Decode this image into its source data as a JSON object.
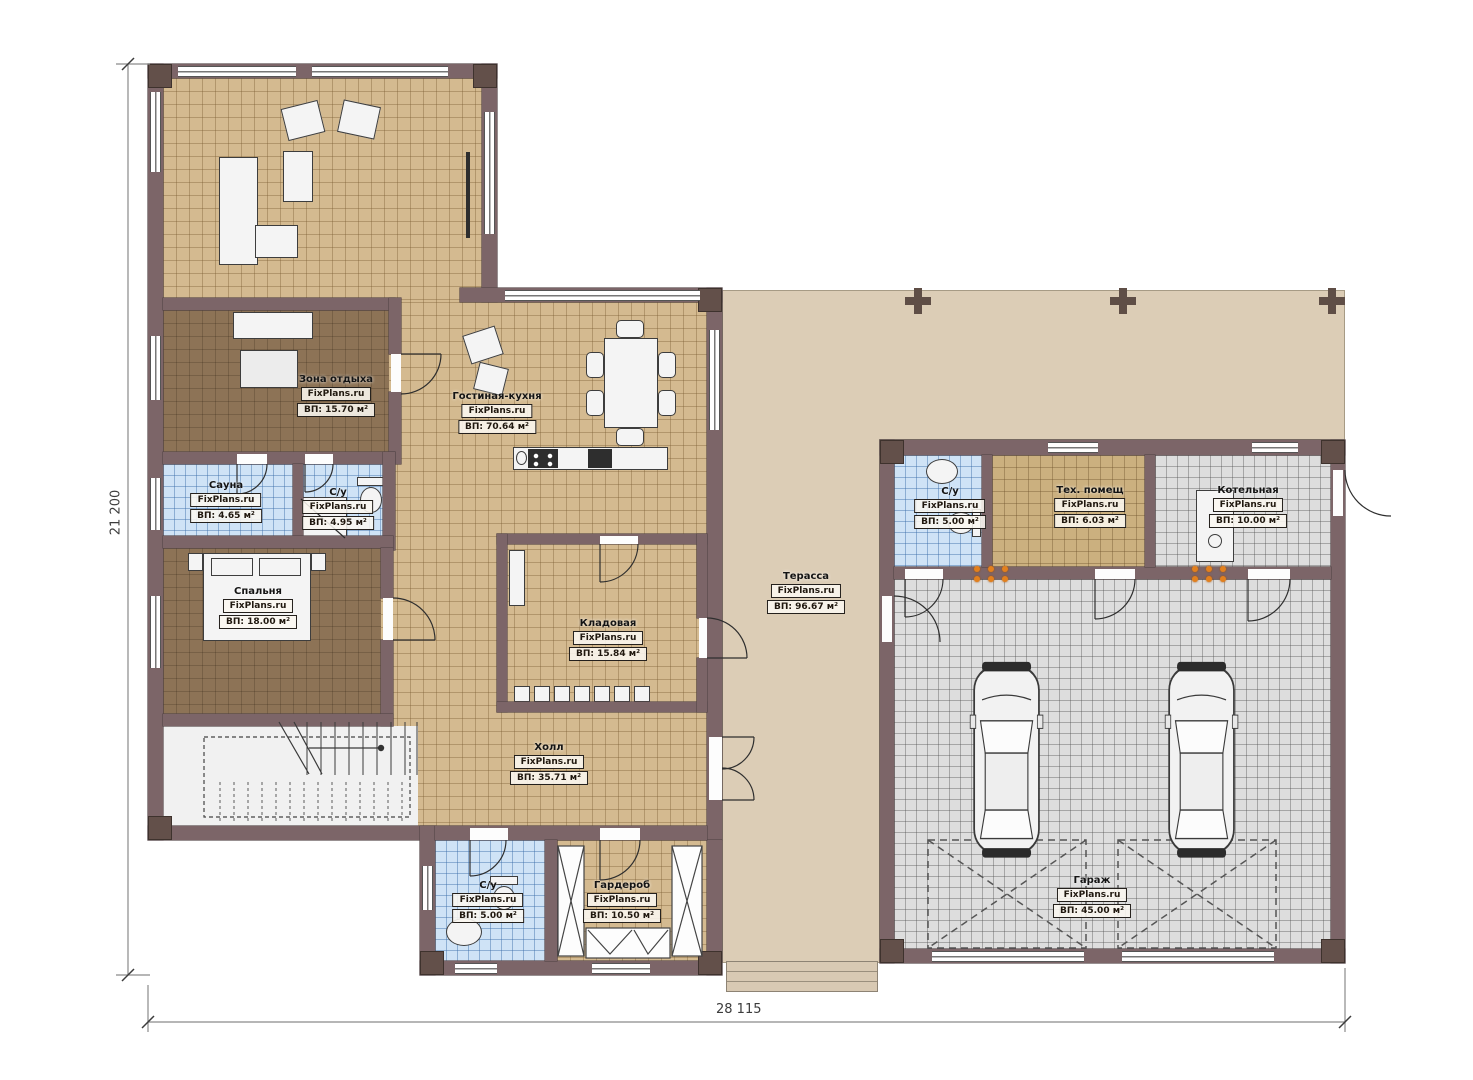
{
  "plan": {
    "brand": "FixPlans.ru",
    "rooms": [
      {
        "id": "zona",
        "name": "Зона отдыха",
        "area": "ВП: 15.70 м²"
      },
      {
        "id": "living",
        "name": "Гостиная-кухня",
        "area": "ВП: 70.64 м²"
      },
      {
        "id": "sauna",
        "name": "Сауна",
        "area": "ВП: 4.65 м²"
      },
      {
        "id": "su1",
        "name": "С/у",
        "area": "ВП: 4.95 м²"
      },
      {
        "id": "bedroom",
        "name": "Спальня",
        "area": "ВП: 18.00 м²"
      },
      {
        "id": "storage",
        "name": "Кладовая",
        "area": "ВП: 15.84 м²"
      },
      {
        "id": "terrace",
        "name": "Терасса",
        "area": "ВП: 96.67 м²"
      },
      {
        "id": "hall",
        "name": "Холл",
        "area": "ВП: 35.71 м²"
      },
      {
        "id": "su2",
        "name": "С/у",
        "area": "ВП: 5.00 м²"
      },
      {
        "id": "wardrobe",
        "name": "Гардероб",
        "area": "ВП: 10.50 м²"
      },
      {
        "id": "su3",
        "name": "С/у",
        "area": "ВП: 5.00 м²"
      },
      {
        "id": "tech",
        "name": "Тех. помещ",
        "area": "ВП: 6.03 м²"
      },
      {
        "id": "boiler",
        "name": "Котельная",
        "area": "ВП: 10.00 м²"
      },
      {
        "id": "garage",
        "name": "Гараж",
        "area": "ВП: 45.00 м²"
      }
    ],
    "dimensions": {
      "height_label": "21 200",
      "width_label": "28 115"
    },
    "colors": {
      "wall": "#7c6568",
      "tile_tan": "#d4ba90",
      "floor_brown": "#8d7356",
      "tile_blue": "#cfe3f6",
      "tile_gray": "#dddddd",
      "terrace": "#dccdb6",
      "accent_orange": "#e2801e"
    }
  }
}
